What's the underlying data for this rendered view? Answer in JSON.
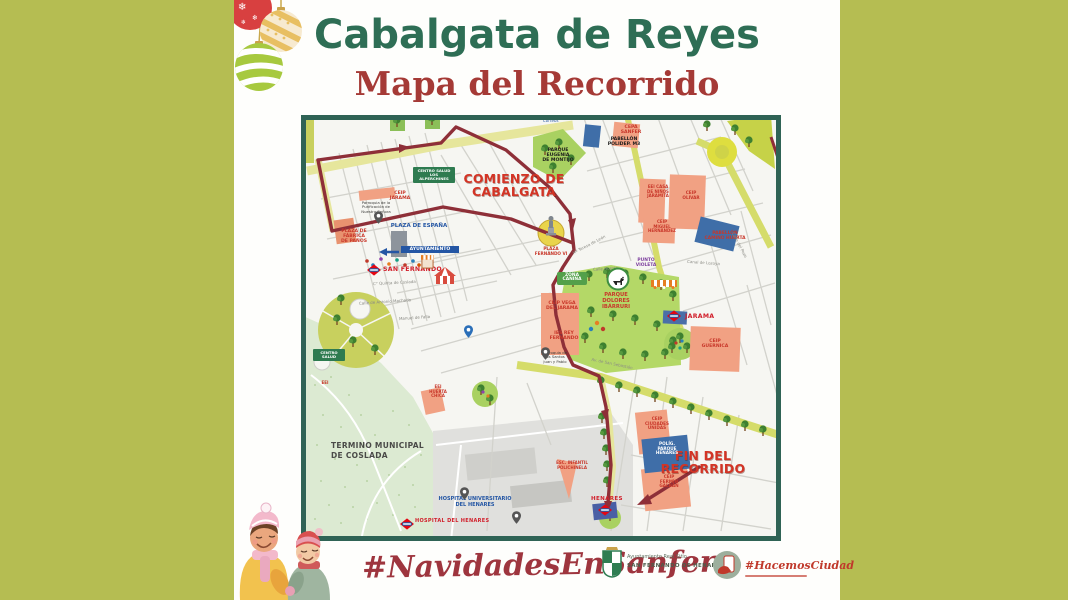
{
  "header": {
    "title": "Cabalgata de Reyes",
    "subtitle": "Mapa del Recorrido"
  },
  "footer": {
    "hashtag": "#NavidadesEnSanfer",
    "council": {
      "line1": "Ayuntamiento Real Sitio",
      "line2": "SAN FERNANDO DE HENARES"
    },
    "hacemos": {
      "label": "#HacemosCiudad"
    }
  },
  "colors": {
    "background_olive": "#b5bd52",
    "title_green": "#2e6e55",
    "title_red": "#a53a36",
    "route_maroon": "#8e2f38",
    "park_green": "#b4d867",
    "school_salmon": "#f1a183",
    "pavilion_blue": "#3f6ea8",
    "big_label_red": "#d33425"
  },
  "map": {
    "labels": [
      {
        "id": "label-comienzo",
        "t": "COMIENZO DE\nCABALGATA",
        "x": 148,
        "y": 57,
        "c": "rl",
        "w": 130
      },
      {
        "id": "label-fin",
        "t": "FIN DEL\nRECORRIDO",
        "x": 352,
        "y": 334,
        "c": "rl",
        "w": 100
      },
      {
        "id": "label-plaza-fernando",
        "t": "PLAZA\nFERNANDO VI",
        "x": 228,
        "y": 132,
        "c": "rs",
        "fs": 4.2,
        "w": 44
      },
      {
        "id": "label-plaza-espana",
        "t": "PLAZA DE ESPAÑA",
        "x": 82,
        "y": 108,
        "c": "bl",
        "w": 72
      },
      {
        "id": "label-centro-salud",
        "t": "CENTRO SALUD\nLOS ALPERCHINES",
        "x": 112,
        "y": 52,
        "c": "wg",
        "w": 38
      },
      {
        "id": "label-ceip-jarama",
        "t": "CEIP\nJARAMA",
        "x": 84,
        "y": 76,
        "c": "rs",
        "w": 30
      },
      {
        "id": "label-parroquia-purificacion",
        "t": "Parroquia de la\nPurificación de\nNuestra Señora",
        "x": 54,
        "y": 86,
        "c": "bk",
        "w": 42
      },
      {
        "id": "label-plaza-fabrica",
        "t": "PLAZA DE\nFÁBRICA\nDE PAÑOS",
        "x": 34,
        "y": 114,
        "c": "rs",
        "w": 38
      },
      {
        "id": "label-ayuntamiento",
        "t": "AYUNTAMIENTO",
        "x": 100,
        "y": 131,
        "c": "wb",
        "w": 54
      },
      {
        "id": "label-san-fernando",
        "t": "SAN FERNANDO",
        "x": 82,
        "y": 151,
        "c": "mt",
        "fs": 6.2
      },
      {
        "id": "label-zona-canina",
        "t": "ZONA\nCANINA",
        "x": 256,
        "y": 157,
        "c": "wg2",
        "w": 26
      },
      {
        "id": "label-parque-dolores",
        "t": "PARQUE\nDOLORES\nIBÁRRURI",
        "x": 292,
        "y": 178,
        "c": "rs",
        "fs": 5.2,
        "w": 46
      },
      {
        "id": "label-punto-violeta",
        "t": "PUNTO\nVIOLETA",
        "x": 330,
        "y": 144,
        "c": "pu",
        "w": 30
      },
      {
        "id": "label-ceip-vega",
        "t": "CEIP VEGA\nDEL JARAMA",
        "x": 241,
        "y": 186,
        "c": "rs",
        "w": 40
      },
      {
        "id": "label-ies-rey",
        "t": "IES REY\nFERNANDO",
        "x": 244,
        "y": 216,
        "c": "rs",
        "w": 38
      },
      {
        "id": "label-parroquia-santos",
        "t": "Parroquia de\nlos Santos\nJuan y Pablo",
        "x": 236,
        "y": 236,
        "c": "bk",
        "w": 36
      },
      {
        "id": "label-jarama",
        "t": "JARAMA",
        "x": 384,
        "y": 198,
        "c": "mt",
        "fs": 6.2
      },
      {
        "id": "label-ceip-guernica",
        "t": "CEIP\nGUERNICA",
        "x": 394,
        "y": 224,
        "c": "rs",
        "w": 40
      },
      {
        "id": "label-parque-eugenia",
        "t": "PARQUE\nEUGENIA\nDE MONTIJO",
        "x": 234,
        "y": 33,
        "c": "bks",
        "w": 46
      },
      {
        "id": "label-pabellon-m3",
        "t": "PABELLÓN\nPOLIDEP. M3",
        "x": 300,
        "y": 22,
        "c": "bks",
        "w": 46
      },
      {
        "id": "label-cepa-sanfer",
        "t": "CEPA\nSANFER",
        "x": 316,
        "y": 10,
        "c": "rs",
        "w": 28
      },
      {
        "id": "label-eei-jaramita",
        "t": "EEI CASA\nDE NIÑOS\nJARAMITA",
        "x": 341,
        "y": 70,
        "c": "rs",
        "fs": 4,
        "w": 32
      },
      {
        "id": "label-ceip-olivar",
        "t": "CEIP\nOLIVAR",
        "x": 376,
        "y": 76,
        "c": "rs",
        "fs": 4.2,
        "w": 28
      },
      {
        "id": "label-ceip-miguel",
        "t": "CEIP\nMIGUEL\nHERNÁNDEZ",
        "x": 344,
        "y": 105,
        "c": "rs",
        "fs": 4,
        "w": 34
      },
      {
        "id": "label-pabellon-camino",
        "t": "PABELLÓN\nCAMINO HUERTA",
        "x": 398,
        "y": 117,
        "c": "rs",
        "fs": 4.4,
        "w": 52
      },
      {
        "id": "label-termino",
        "t": "TERMINO MUNICIPAL\nDE COSLADA",
        "x": 30,
        "y": 326,
        "c": "gyb",
        "w": 130
      },
      {
        "id": "label-hospital-universitario",
        "t": "HOSPITAL UNIVERSITARIO\nDEL HENARES",
        "x": 116,
        "y": 382,
        "c": "bl",
        "fs": 5,
        "w": 116
      },
      {
        "id": "label-hospital-henares",
        "t": "HOSPITAL\nDEL HENARES",
        "x": 114,
        "y": 404,
        "c": "mt",
        "fs": 5
      },
      {
        "id": "label-eei-huerta-chica",
        "t": "EEI\nHUERTA\nCHICA",
        "x": 124,
        "y": 270,
        "c": "rs",
        "fs": 4,
        "w": 26
      },
      {
        "id": "label-centro-salud-2",
        "t": "CENTRO\nSALUD",
        "x": 12,
        "y": 234,
        "c": "wg",
        "w": 28
      },
      {
        "id": "label-eei-west",
        "t": "EEI",
        "x": 14,
        "y": 266,
        "c": "rs",
        "fs": 4,
        "w": 20
      },
      {
        "id": "label-esc-polichinela",
        "t": "ESC. INFANTIL\nPOLICHINELA",
        "x": 248,
        "y": 346,
        "c": "rs",
        "fs": 4,
        "w": 46
      },
      {
        "id": "label-ceip-ciudades",
        "t": "CEIP\nCIUDADES\nUNIDAS",
        "x": 339,
        "y": 302,
        "c": "rs",
        "fs": 4.2,
        "w": 34
      },
      {
        "id": "label-poligono-henares",
        "t": "POLÍG.\nPARQUE\nHENARES",
        "x": 348,
        "y": 327,
        "c": "wbk",
        "w": 36
      },
      {
        "id": "label-ceip-galban",
        "t": "CEIP\nFERMÍN\nGALBÁN",
        "x": 352,
        "y": 360,
        "c": "rs",
        "fs": 4.2,
        "w": 32
      },
      {
        "id": "label-henares",
        "t": "HENARES",
        "x": 290,
        "y": 381,
        "c": "mt",
        "fs": 5.6
      },
      {
        "id": "label-correos",
        "t": "Correos",
        "x": 242,
        "y": 4,
        "c": "corr",
        "w": 26
      },
      {
        "id": "street-quinta-coslada",
        "t": "C° Quinta de Coslada",
        "x": 72,
        "y": 166,
        "c": "st",
        "r": -3
      },
      {
        "id": "street-antonio-machado",
        "t": "Calle de Antonio Machado",
        "x": 58,
        "y": 185,
        "c": "st",
        "r": -4
      },
      {
        "id": "street-manuel-falla",
        "t": "Manuel de Falla",
        "x": 98,
        "y": 201,
        "c": "st",
        "r": -4
      },
      {
        "id": "street-huerta",
        "t": "Calle Huerta",
        "x": 292,
        "y": 152,
        "c": "st",
        "r": -4
      },
      {
        "id": "street-canal-lozoya",
        "t": "Canal de Lozoya",
        "x": 386,
        "y": 146,
        "c": "st",
        "r": 4
      },
      {
        "id": "street-teresa-leon",
        "t": "Mª Teresa de León",
        "x": 270,
        "y": 128,
        "c": "st",
        "r": -28
      },
      {
        "id": "street-san-sebastian",
        "t": "Av. de San Sebastián",
        "x": 290,
        "y": 247,
        "c": "st",
        "r": 12
      },
      {
        "id": "street-pozo",
        "t": "Calle del Pozo",
        "x": 424,
        "y": 128,
        "c": "st",
        "r": 62
      }
    ],
    "icons": [
      {
        "n": "metro-icon",
        "x": 66,
        "y": 149
      },
      {
        "n": "metro-icon",
        "x": 366,
        "y": 195
      },
      {
        "n": "metro-icon",
        "x": 297,
        "y": 389
      },
      {
        "n": "metro-icon",
        "x": 99,
        "y": 403
      },
      {
        "n": "statue-icon",
        "x": 243,
        "y": 99
      },
      {
        "n": "carousel-icon",
        "x": 133,
        "y": 152
      },
      {
        "n": "market-icon",
        "x": 120,
        "y": 140
      },
      {
        "n": "awning-icon",
        "x": 350,
        "y": 165
      },
      {
        "n": "dog-badge-icon",
        "x": 305,
        "y": 152
      },
      {
        "n": "pin-icon",
        "x": 73,
        "y": 96
      },
      {
        "n": "pin-icon",
        "x": 159,
        "y": 372
      },
      {
        "n": "pin-icon",
        "x": 211,
        "y": 396
      },
      {
        "n": "pin-icon",
        "x": 240,
        "y": 232
      },
      {
        "n": "pin-blue-icon",
        "x": 163,
        "y": 210
      }
    ]
  }
}
